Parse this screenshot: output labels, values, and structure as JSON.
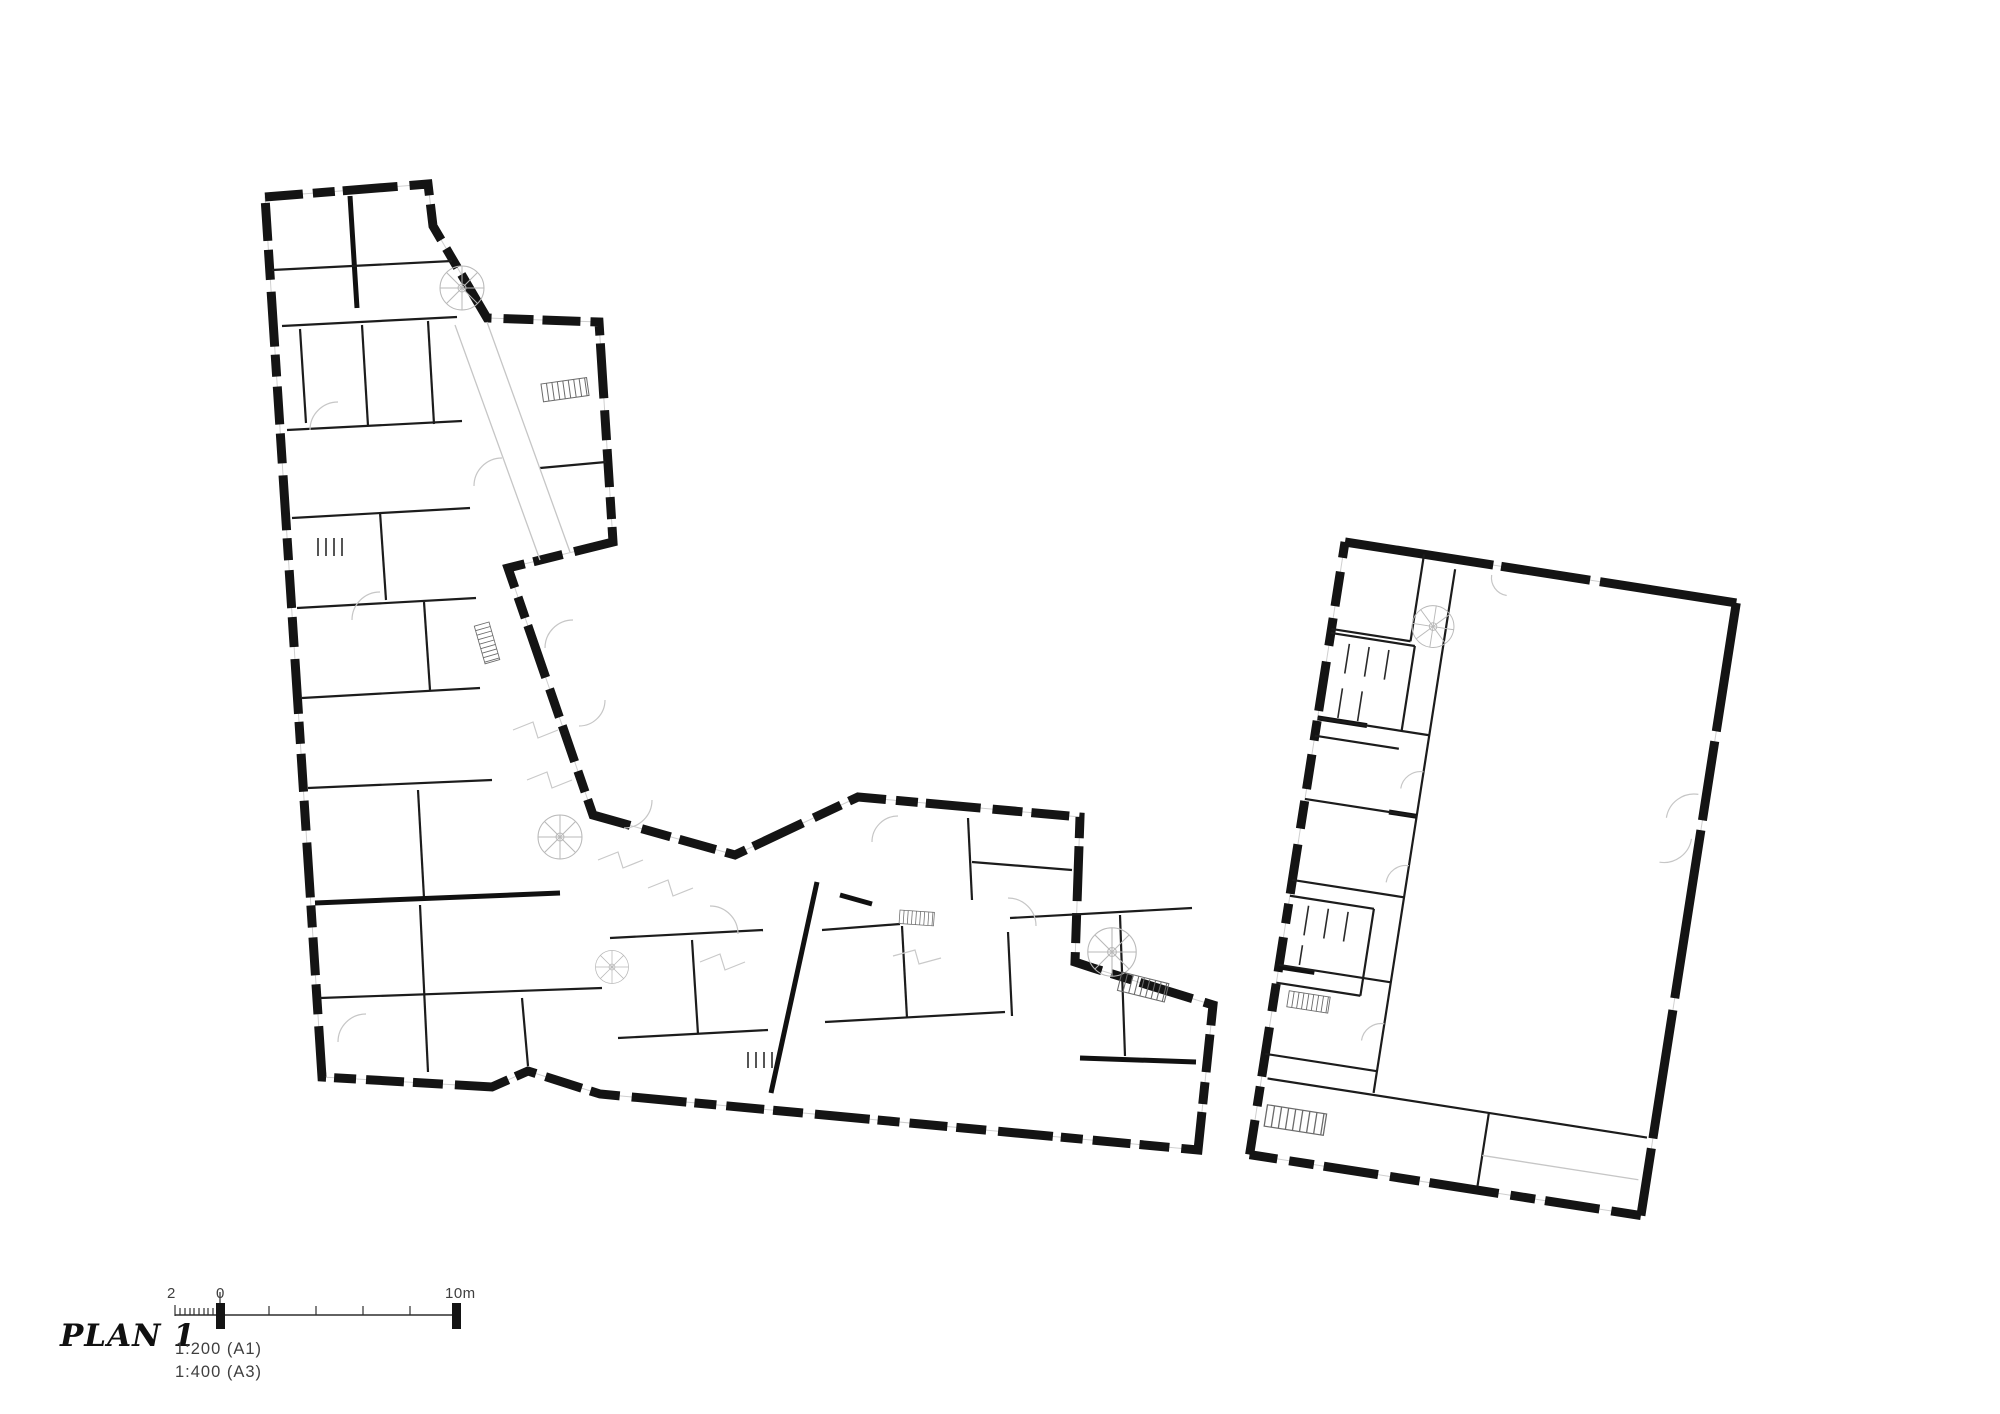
{
  "sheet": {
    "background": "#ffffff",
    "wall_ink": "#141414",
    "detail_ink": "#c6c6c6",
    "text_ink": "#3f3f3f"
  },
  "titleblock": {
    "title": "PLAN 1",
    "scalebar": {
      "label_left": "2",
      "label_zero": "0",
      "label_right": "10m",
      "scale_line_1": "1:200   (A1)",
      "scale_line_2": "1:400   (A3)"
    }
  }
}
